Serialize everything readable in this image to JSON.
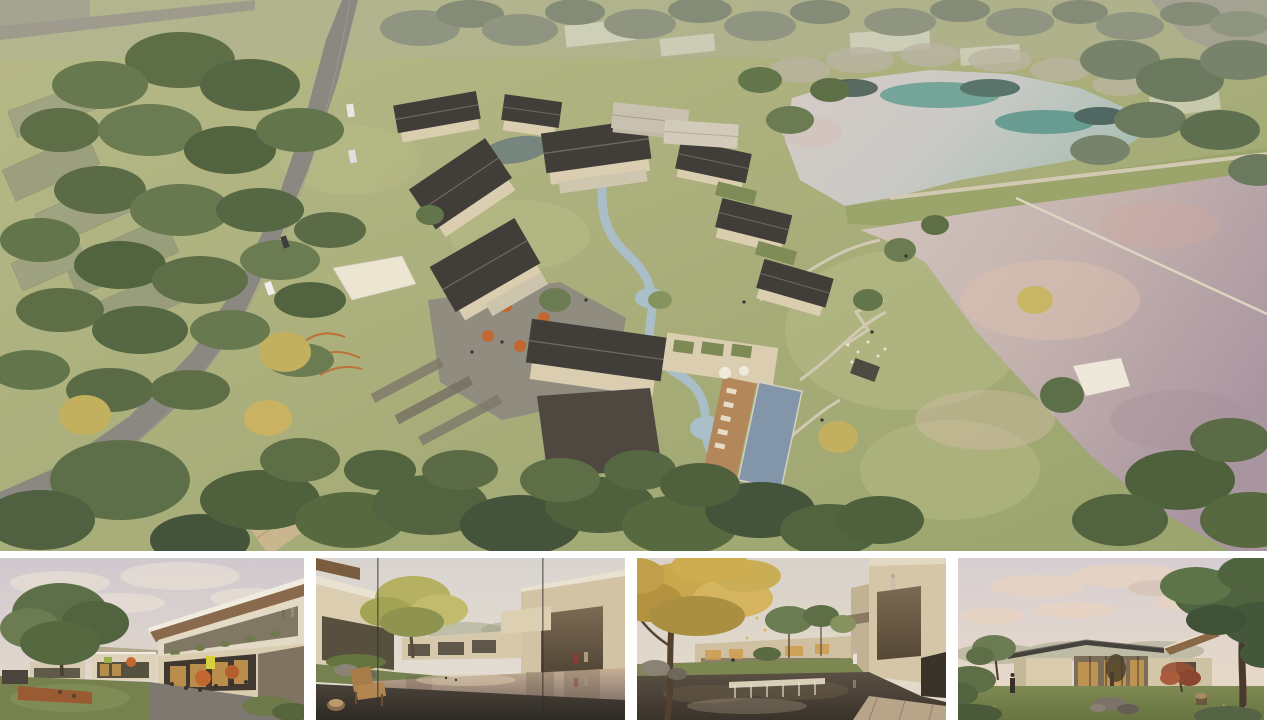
{
  "meta": {
    "type": "architectural-rendering-collage",
    "description": "Presentation board with one large aerial rendering of a resort village and four eye-level renderings below. No text is visible in the image."
  },
  "palette": {
    "grass": "#a9ae7b",
    "grassLight": "#b8bb87",
    "grassDark": "#97a066",
    "treeDark": "#4e603c",
    "treeMid": "#63754a",
    "treeLight": "#7e8d5e",
    "treeDesat": "#8f9581",
    "treeYellow": "#c3b05e",
    "road": "#8b8781",
    "path": "#d2c9b2",
    "roofDark": "#413d39",
    "roofLight": "#c8c1b0",
    "wall": "#dacdb0",
    "stoneDark": "#4e4841",
    "deck": "#b3875a",
    "pool": "#8396a9",
    "stream": "#a9bfca",
    "pondTeal": "#57998a",
    "umbrella": "#c2672f",
    "canopy": "#ece5d2",
    "ghost": "#b9b4a2",
    "woodSoffit": "#8a6a4c",
    "glassDark": "#4a443a",
    "warmLight": "#cf9c50",
    "corten": "#9a5b33",
    "signYellow": "#d6cf3e",
    "maple": "#9a4f35"
  },
  "main_view": {
    "name": "aerial-masterplan-render",
    "description": "Aerial rendering of a resort village: courtyard houses with dark gabled roofs around a winding stream, outdoor cafe plaza with orange umbrellas, climbing-net playground, shade sails, swimming pool with timber sun deck, curving country road with cars and farm plots to the west, ghosted future buildings to the north, and two large ponds separated by an embankment path with a floating walkway to the east.",
    "scene_stats": {
      "dark_roof_buildings": 9,
      "light_roof_barns": 2,
      "ponds": 2,
      "cars_on_road": 4,
      "orange_umbrellas_plaza": 5,
      "shade_canopies": 2,
      "swimming_pools": 1
    }
  },
  "thumbnails": [
    {
      "name": "plaza-cafe-view",
      "description": "Dusk eye-level view of a two-storey cafe building with timber roof soffit and balcony, orange umbrellas over tables, people on a stone plaza, a corten planter and a large tree beside a lawn."
    },
    {
      "name": "water-courtyard-view",
      "description": "View across a still reflecting pond framed by beige flat-roofed houses, a yellow-green tree and grass slope at left, a wooden lounge chair and stump stool on a dark stone deck in the foreground, two visitors walking at right."
    },
    {
      "name": "autumn-courtyard-view",
      "description": "Courtyard with a large golden-leafed tree, a pond spilling over a stone weir, lawns with low buildings beyond, and a cantilevered beige building with a visitor on its roof terrace."
    },
    {
      "name": "lawn-pavilion-view",
      "description": "Single-storey glazed pavilion with a thin dark low roof and warm interior light on a lawn at dusk, framed by a mature tree, a red maple, rocks, a stump and tall grasses."
    }
  ]
}
